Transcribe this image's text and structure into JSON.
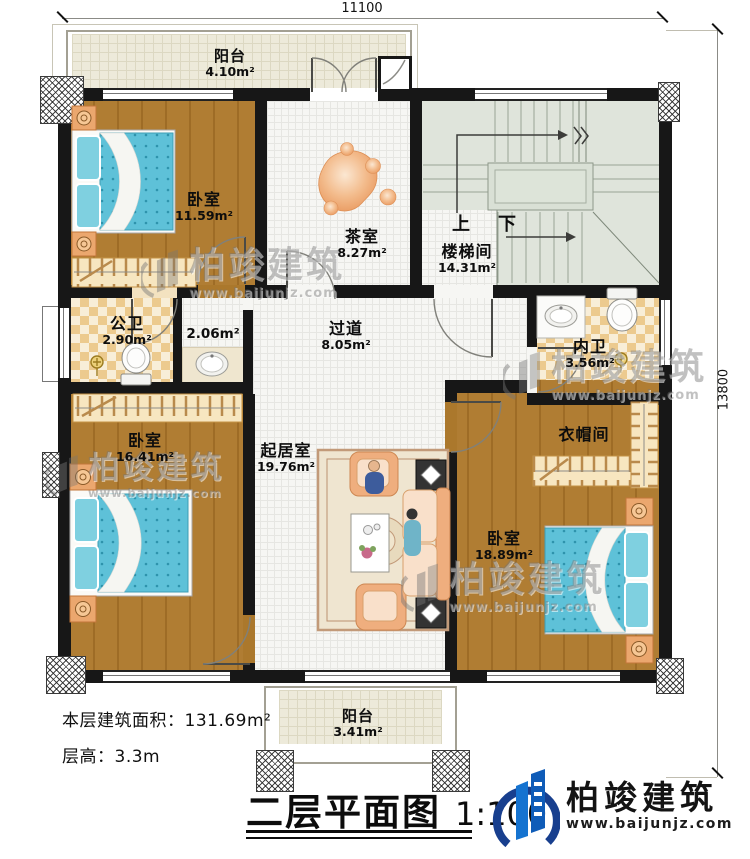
{
  "dimensions": {
    "width_label": "11100",
    "height_label": "13800"
  },
  "rooms": {
    "balcony_top": {
      "name": "阳台",
      "area": "4.10m²"
    },
    "bedroom1": {
      "name": "卧室",
      "area": "11.59m²"
    },
    "tea_room": {
      "name": "茶室",
      "area": "8.27m²"
    },
    "stairwell": {
      "name": "楼梯间",
      "area": "14.31m²",
      "up": "上",
      "down": "下"
    },
    "public_bath": {
      "name": "公卫",
      "area": "2.90m²"
    },
    "wash_area": {
      "area": "2.06m²"
    },
    "corridor": {
      "name": "过道",
      "area": "8.05m²"
    },
    "private_bath": {
      "name": "内卫",
      "area": "3.56m²"
    },
    "bedroom2": {
      "name": "卧室",
      "area": "16.41m²"
    },
    "living_room": {
      "name": "起居室",
      "area": "19.76m²"
    },
    "cloakroom": {
      "name": "衣帽间"
    },
    "bedroom3": {
      "name": "卧室",
      "area": "18.89m²"
    },
    "balcony_bottom": {
      "name": "阳台",
      "area": "3.41m²"
    }
  },
  "notes": {
    "floor_area": "本层建筑面积：131.69m²",
    "floor_height": "层高：3.3m"
  },
  "title_block": {
    "title": "二层平面图",
    "scale": "1:100"
  },
  "brand": {
    "name": "柏竣建筑",
    "url": "www.baijunjz.com"
  },
  "watermark": {
    "name": "柏竣建筑",
    "url": "www.baijunjz.com"
  },
  "colors": {
    "wall": "#171717",
    "wood_floor": "#ab782c",
    "bath_tile": "#ecca8e",
    "bed": "#5ec1d8",
    "stair": "#dfe4db",
    "balcony": "#edeada",
    "brand_blue": "#1573d0",
    "brand_navy": "#183f8e",
    "watermark_gray": "#767676"
  }
}
